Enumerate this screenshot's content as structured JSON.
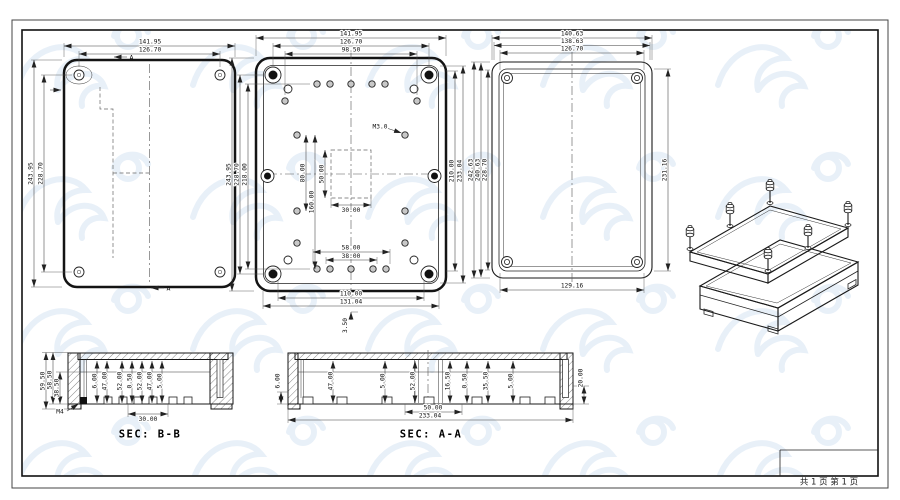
{
  "page": {
    "footer": "共 1 页  第 1 页"
  },
  "view_lid_outside": {
    "marker": "A",
    "dims": {
      "top": [
        "141.95",
        "126.70"
      ],
      "left": [
        "243.95",
        "228.70"
      ]
    }
  },
  "view_base_inside": {
    "thread_label": "M3.0",
    "dims": {
      "top": [
        "141.95",
        "126.70",
        "98.50"
      ],
      "left": [
        "243.95",
        "228.70",
        "218.00"
      ],
      "inner_vertical": [
        "80.00",
        "160.00"
      ],
      "pocket": [
        "50.00",
        "30.00"
      ],
      "right": [
        "210.00",
        "233.04"
      ],
      "bottom": [
        "58.00",
        "38.00",
        "110.00",
        "131.04"
      ],
      "base_thickness": "3.50"
    }
  },
  "view_lid_inside": {
    "dims": {
      "top": [
        "140.63",
        "138.63",
        "126.70"
      ],
      "left": [
        "242.63",
        "240.63",
        "228.70"
      ],
      "right": "231.16",
      "bottom": "129.16"
    }
  },
  "section_bb": {
    "title": "SEC: B-B",
    "insert_label": "M4",
    "left_dims": [
      "59.50",
      "58.50",
      "38.50"
    ],
    "inner_dims": [
      "6.00",
      "47.00",
      "52.00",
      "0.50",
      "52.00",
      "47.00",
      "5.00"
    ],
    "bottom_dim": "30.00"
  },
  "section_aa": {
    "title": "SEC: A-A",
    "left_dim": "6.00",
    "inner_dims": [
      "47.00",
      "5.00",
      "52.00",
      "16.50",
      "0.50",
      "35.50",
      "5.00"
    ],
    "right_dim": "20.00",
    "bottom_dims": [
      "50.00",
      "233.04"
    ]
  }
}
